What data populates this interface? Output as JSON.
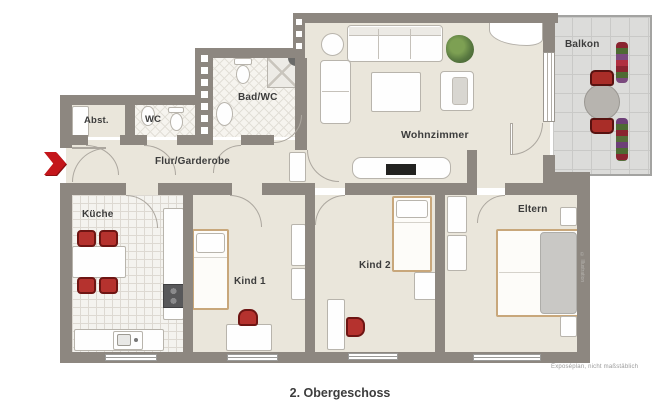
{
  "plan": {
    "caption": "2. Obergeschoss",
    "disclaimer": "Exposéplan, nicht maßstäblich",
    "watermark_text": "© Illustration",
    "rooms": {
      "abst": {
        "label": "Abst."
      },
      "wc": {
        "label": "WC"
      },
      "bad_wc": {
        "label": "Bad/WC"
      },
      "flur": {
        "label": "Flur/Garderobe"
      },
      "wohnzimmer": {
        "label": "Wohnzimmer"
      },
      "balkon": {
        "label": "Balkon"
      },
      "kueche": {
        "label": "Küche"
      },
      "kind1": {
        "label": "Kind 1"
      },
      "kind2": {
        "label": "Kind 2"
      },
      "eltern": {
        "label": "Eltern"
      }
    },
    "icons": {
      "entrance_arrow": "red chevron marking apartment entrance"
    },
    "colors": {
      "wall": "#8d8780",
      "floor_beige": "#eae6db",
      "accent_red": "#c4161b",
      "balcony_tile": "#dcdcda",
      "wood_frame": "#c8a77b",
      "label_text": "#3c3c3c"
    }
  }
}
